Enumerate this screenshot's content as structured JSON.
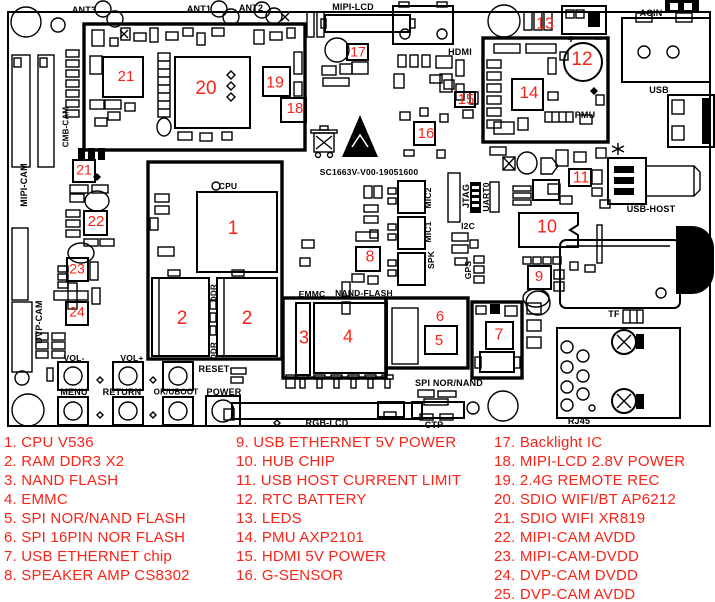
{
  "page": {
    "width": 715,
    "height": 602,
    "background": "#ffffff"
  },
  "colors": {
    "marker_red": "#fa2318",
    "legend_red": "#fa2318",
    "silk_black": "#000000"
  },
  "board": {
    "silk": [
      {
        "t": "ANT3",
        "x": 84,
        "y": 10
      },
      {
        "t": "ANT1",
        "x": 199,
        "y": 9
      },
      {
        "t": "ANT2",
        "x": 251,
        "y": 8
      },
      {
        "t": "MIPI-LCD",
        "x": 353,
        "y": 7
      },
      {
        "t": "HDMI",
        "x": 460,
        "y": 52
      },
      {
        "t": "ACIN",
        "x": 651,
        "y": 13
      },
      {
        "t": "USB",
        "x": 659,
        "y": 90
      },
      {
        "t": "PMU",
        "x": 585,
        "y": 115
      },
      {
        "t": "CPU",
        "x": 228,
        "y": 186,
        "fs": 8.5
      },
      {
        "t": "SC1663V-V00-19051600",
        "x": 369,
        "y": 172,
        "fs": 8.5
      },
      {
        "t": "MIC2",
        "x": 428,
        "y": 198,
        "v": true,
        "fs": 8.5
      },
      {
        "t": "MIC1",
        "x": 428,
        "y": 232,
        "v": true,
        "fs": 8.5
      },
      {
        "t": "SPK",
        "x": 431,
        "y": 260,
        "v": true,
        "fs": 8.5
      },
      {
        "t": "JTAG",
        "x": 466,
        "y": 196,
        "v": true
      },
      {
        "t": "UART0",
        "x": 486,
        "y": 197,
        "v": true,
        "fs": 8.5
      },
      {
        "t": "I2C",
        "x": 468,
        "y": 226,
        "fs": 8.5
      },
      {
        "t": "GPS",
        "x": 468,
        "y": 270,
        "v": true,
        "fs": 8.5
      },
      {
        "t": "EMMC",
        "x": 312,
        "y": 294,
        "fs": 8.5
      },
      {
        "t": "NAND-FLASH",
        "x": 364,
        "y": 293,
        "fs": 8.5
      },
      {
        "t": "DDR",
        "x": 214,
        "y": 293,
        "v": true,
        "fs": 8
      },
      {
        "t": "DDR",
        "x": 214,
        "y": 351,
        "v": true,
        "fs": 8
      },
      {
        "t": "VOL-",
        "x": 74,
        "y": 358,
        "fs": 8.5
      },
      {
        "t": "VOL+",
        "x": 132,
        "y": 358,
        "fs": 8.5
      },
      {
        "t": "MENU",
        "x": 74,
        "y": 392
      },
      {
        "t": "RETURN",
        "x": 122,
        "y": 392
      },
      {
        "t": "OK/UBOOT",
        "x": 176,
        "y": 392,
        "fs": 8
      },
      {
        "t": "RESET",
        "x": 214,
        "y": 369
      },
      {
        "t": "POWER",
        "x": 224,
        "y": 392
      },
      {
        "t": "RGB-LCD",
        "x": 327,
        "y": 423
      },
      {
        "t": "SPI NOR/NAND",
        "x": 449,
        "y": 383
      },
      {
        "t": "CTP",
        "x": 434,
        "y": 425
      },
      {
        "t": "USB-HOST",
        "x": 651,
        "y": 209
      },
      {
        "t": "TF",
        "x": 614,
        "y": 314
      },
      {
        "t": "RJ45",
        "x": 579,
        "y": 421
      },
      {
        "t": "CMB-CAM",
        "x": 66,
        "y": 127,
        "v": true,
        "fs": 8
      },
      {
        "t": "MIPI-CAM",
        "x": 24,
        "y": 185,
        "v": true
      },
      {
        "t": "DVP-CAM",
        "x": 39,
        "y": 322,
        "v": true
      }
    ],
    "markers": [
      {
        "n": "1",
        "x": 233,
        "y": 230,
        "s": 19
      },
      {
        "n": "2",
        "x": 182,
        "y": 320,
        "s": 19
      },
      {
        "n": "2",
        "x": 247,
        "y": 320,
        "s": 19
      },
      {
        "n": "3",
        "x": 304,
        "y": 339,
        "s": 18
      },
      {
        "n": "4",
        "x": 348,
        "y": 338,
        "s": 18
      },
      {
        "n": "5",
        "x": 439,
        "y": 341,
        "s": 15
      },
      {
        "n": "6",
        "x": 440,
        "y": 317,
        "s": 15
      },
      {
        "n": "7",
        "x": 499,
        "y": 336,
        "s": 16
      },
      {
        "n": "8",
        "x": 370,
        "y": 258,
        "s": 16
      },
      {
        "n": "9",
        "x": 539,
        "y": 277,
        "s": 15
      },
      {
        "n": "10",
        "x": 547,
        "y": 228,
        "s": 18
      },
      {
        "n": "11",
        "x": 581,
        "y": 179,
        "s": 16
      },
      {
        "n": "12",
        "x": 582,
        "y": 61,
        "s": 19
      },
      {
        "n": "13",
        "x": 545,
        "y": 25,
        "s": 16
      },
      {
        "n": "14",
        "x": 529,
        "y": 94,
        "s": 17
      },
      {
        "n": "15",
        "x": 466,
        "y": 100,
        "s": 15
      },
      {
        "n": "16",
        "x": 426,
        "y": 134,
        "s": 15
      },
      {
        "n": "17",
        "x": 358,
        "y": 52,
        "s": 14
      },
      {
        "n": "18",
        "x": 295,
        "y": 109,
        "s": 15
      },
      {
        "n": "19",
        "x": 275,
        "y": 84,
        "s": 16
      },
      {
        "n": "20",
        "x": 206,
        "y": 90,
        "s": 19
      },
      {
        "n": "21",
        "x": 126,
        "y": 77,
        "s": 15
      },
      {
        "n": "21",
        "x": 84,
        "y": 170,
        "s": 14
      },
      {
        "n": "22",
        "x": 96,
        "y": 222,
        "s": 15
      },
      {
        "n": "23",
        "x": 77,
        "y": 269,
        "s": 14
      },
      {
        "n": "24",
        "x": 77,
        "y": 312,
        "s": 14
      }
    ]
  },
  "legend": {
    "columns": [
      {
        "x": 4,
        "items": [
          "1. CPU V536",
          "2. RAM DDR3 X2",
          "3. NAND FLASH",
          "4. EMMC",
          "5. SPI NOR/NAND FLASH",
          "6. SPI 16PIN NOR FLASH",
          "7. USB ETHERNET chip",
          "8. SPEAKER AMP CS8302"
        ]
      },
      {
        "x": 236,
        "items": [
          "9. USB ETHERNET 5V POWER",
          "10. HUB CHIP",
          "11. USB HOST CURRENT LIMIT",
          "12. RTC BATTERY",
          "13. LEDS",
          "14. PMU AXP2101",
          "15. HDMI 5V POWER",
          "16. G-SENSOR"
        ]
      },
      {
        "x": 494,
        "items": [
          "17. Backlight IC",
          "18. MIPI-LCD 2.8V POWER",
          "19. 2.4G REMOTE REC",
          "20. SDIO WIFI/BT AP6212",
          "21. SDIO WIFI XR819",
          "22. MIPI-CAM AVDD",
          "23. MIPI-CAM-DVDD",
          "24. DVP-CAM DVDD",
          "25. DVP-CAM AVDD"
        ]
      }
    ]
  }
}
